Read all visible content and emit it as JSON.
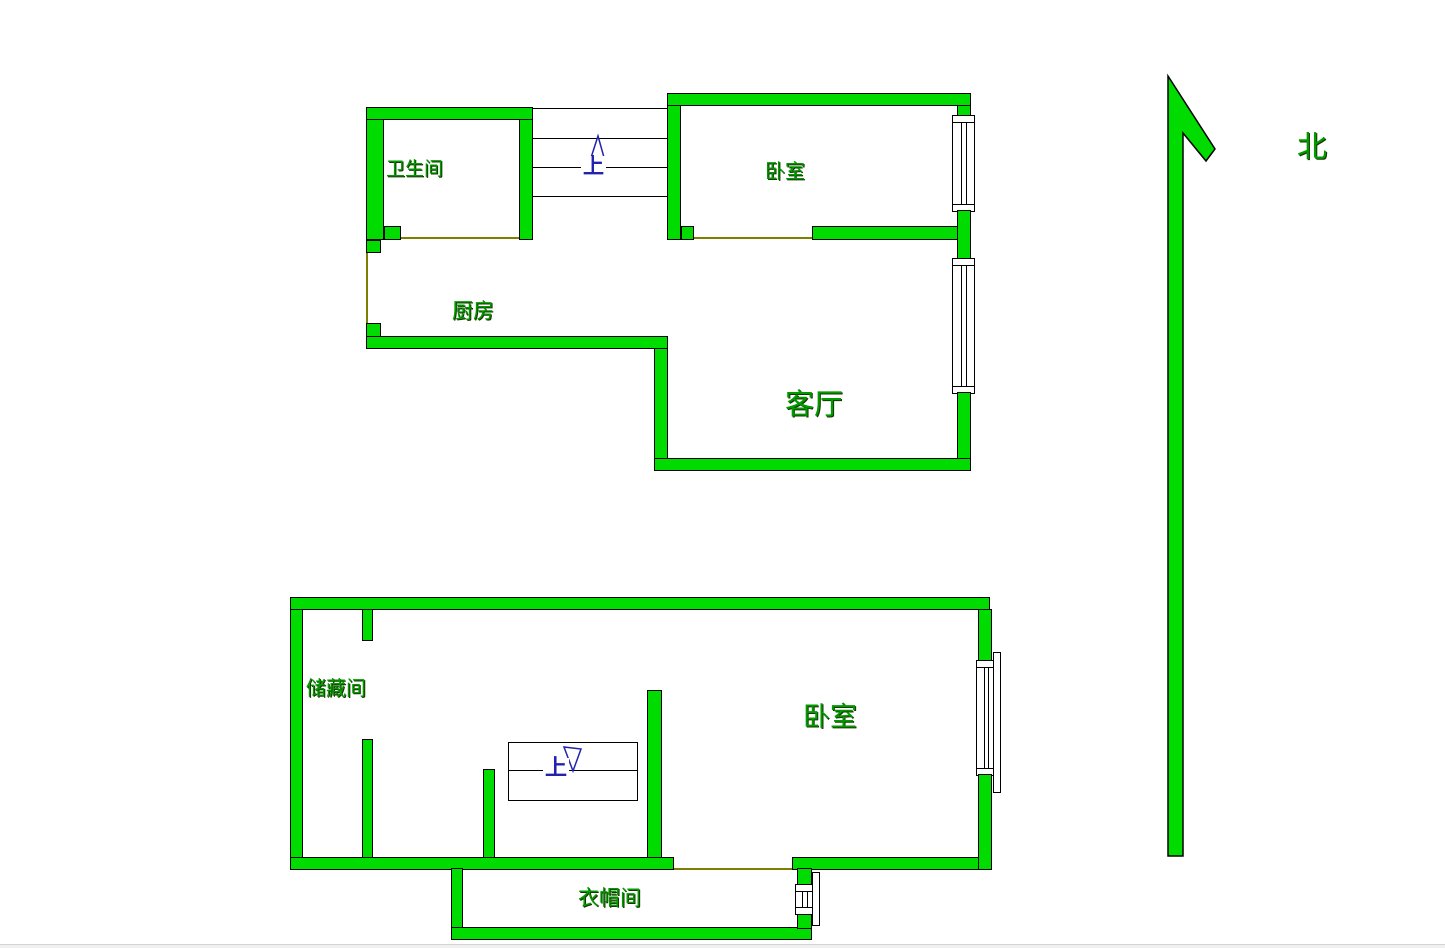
{
  "colors": {
    "wall_fill": "#00DB00",
    "outline": "#000000",
    "opening_line": "#7E7E00",
    "stairs_blue": "#2222AE",
    "label_green": "#009B00"
  },
  "compass": {
    "north_label": "北"
  },
  "upper_floor": {
    "rooms": [
      {
        "id": "bathroom",
        "label": "卫生间"
      },
      {
        "id": "bedroom",
        "label": "卧室"
      },
      {
        "id": "kitchen",
        "label": "厨房"
      },
      {
        "id": "living-room",
        "label": "客厅"
      }
    ],
    "stairs_label": "上"
  },
  "lower_floor": {
    "rooms": [
      {
        "id": "storage-room",
        "label": "储藏间"
      },
      {
        "id": "bedroom",
        "label": "卧室"
      },
      {
        "id": "cloakroom",
        "label": "衣帽间"
      }
    ],
    "stairs_label": "上"
  }
}
